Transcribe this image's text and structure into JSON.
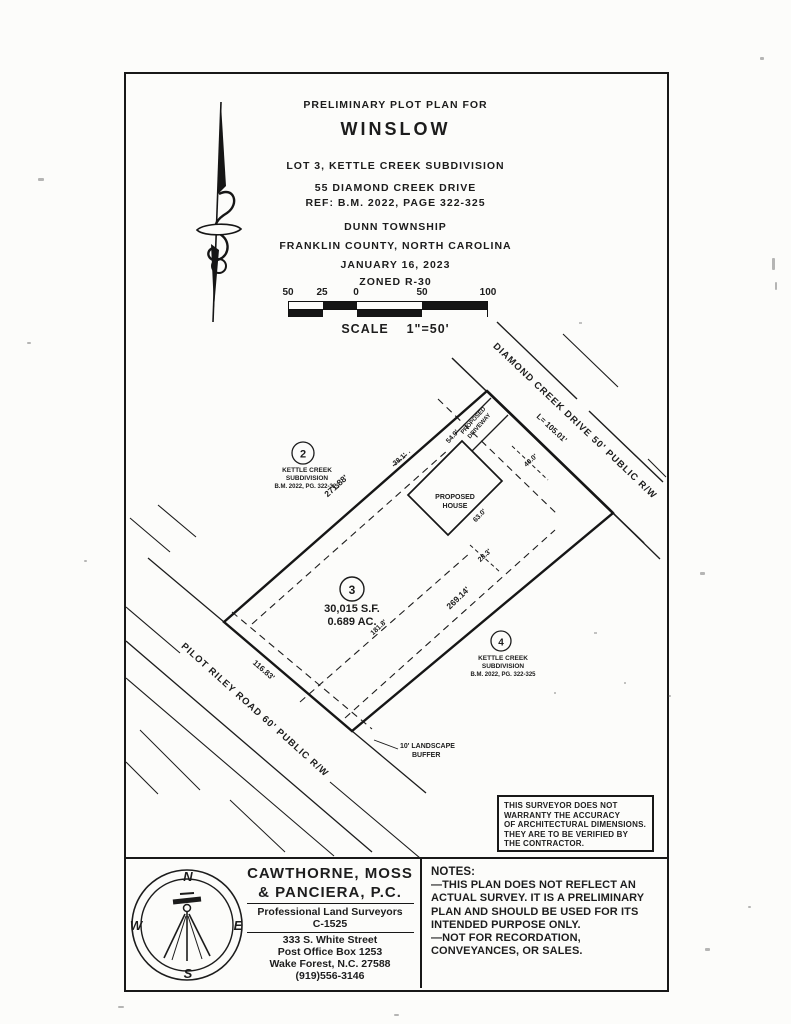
{
  "header": {
    "pre_title": "PRELIMINARY PLOT PLAN FOR",
    "title": "WINSLOW",
    "subtitle": "LOT 3, KETTLE CREEK SUBDIVISION",
    "address": "55 DIAMOND CREEK DRIVE",
    "reference": "REF: B.M. 2022, PAGE 322-325",
    "township": "DUNN TOWNSHIP",
    "county": "FRANKLIN COUNTY, NORTH CAROLINA",
    "date": "JANUARY 16, 2023",
    "zoning": "ZONED R-30"
  },
  "scale_bar": {
    "ticks": [
      "50",
      "25",
      "0",
      "50",
      "100"
    ],
    "label": "SCALE    1\"=50'"
  },
  "plan": {
    "roads": {
      "diamond_creek_drive": "DIAMOND CREEK DRIVE 50' PUBLIC R/W",
      "pilot_riley_road": "PILOT RILEY ROAD 60' PUBLIC R/W"
    },
    "lot2": {
      "number": "2",
      "line1": "KETTLE CREEK",
      "line2": "SUBDIVISION",
      "line3": "B.M. 2022, PG. 322-325"
    },
    "lot3": {
      "number": "3",
      "area_sf": "30,015 S.F.",
      "area_ac": "0.689 AC."
    },
    "lot4": {
      "number": "4",
      "line1": "KETTLE CREEK",
      "line2": "SUBDIVISION",
      "line3": "B.M. 2022, PG. 322-325"
    },
    "house": {
      "line1": "PROPOSED",
      "line2": "HOUSE"
    },
    "driveway": {
      "line1": "PROPOSED",
      "line2": "DRIVEWAY"
    },
    "buffer": {
      "line1": "10' LANDSCAPE",
      "line2": "BUFFER"
    },
    "dims": {
      "frontage_dcd": "L= 105.01'",
      "nw": "271.88'",
      "se": "269.14'",
      "frontage_prr": "116.83'",
      "setback_line": "181.8'",
      "house_a": "54.0'",
      "house_b": "40.0'",
      "house_c": "63.0'",
      "tie_a": "28.3'",
      "tie_b": "38.1'"
    },
    "disclaimer": [
      "THIS SURVEYOR DOES NOT",
      "WARRANTY THE ACCURACY",
      "OF ARCHITECTURAL DIMENSIONS.",
      "THEY ARE TO BE VERIFIED BY",
      "THE CONTRACTOR."
    ]
  },
  "title_block": {
    "firm_line1": "CAWTHORNE, MOSS",
    "firm_line2": "& PANCIERA, P.C.",
    "profession": "Professional Land Surveyors",
    "license": "C-1525",
    "address1": "333 S. White Street",
    "address2": "Post Office Box 1253",
    "address3": "Wake Forest, N.C. 27588",
    "phone": "(919)556-3146",
    "compass": {
      "n": "N",
      "e": "E",
      "s": "S",
      "w": "W"
    }
  },
  "notes": {
    "heading": "NOTES:",
    "note1": "—THIS PLAN DOES NOT REFLECT AN ACTUAL SURVEY. IT IS A PRELIMINARY PLAN AND SHOULD BE USED FOR ITS INTENDED PURPOSE ONLY.",
    "note2": "—NOT FOR RECORDATION, CONVEYANCES, OR SALES."
  }
}
